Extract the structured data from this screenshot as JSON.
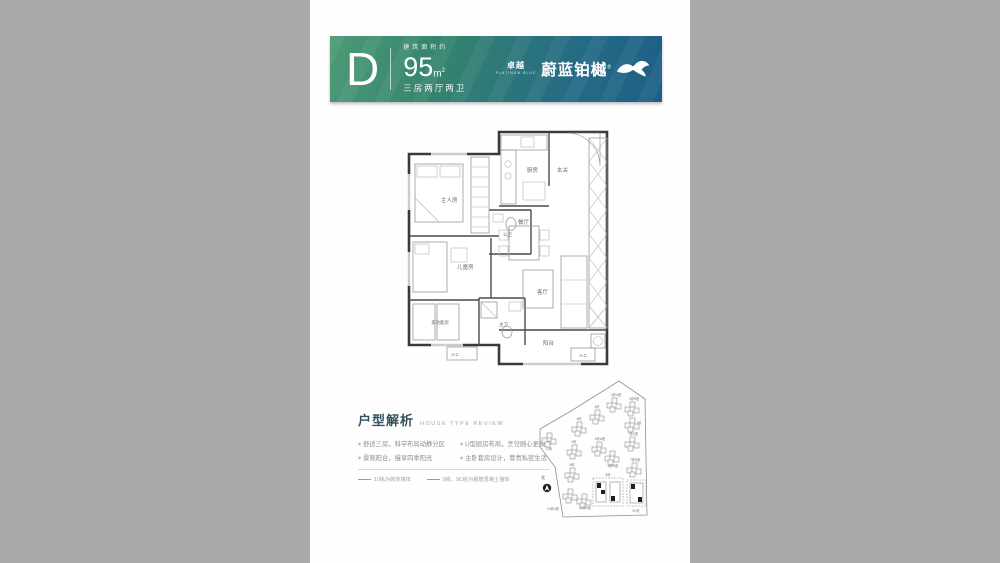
{
  "colors": {
    "side_gray": "#a9a9a9",
    "paper": "#fefefe",
    "banner_green": "#4d9a76",
    "banner_blue": "#1d5f86",
    "title_text": "#33525f"
  },
  "header": {
    "unit_letter": "D",
    "area_prefix": "建筑面积约",
    "area_value": "95",
    "area_unit_m": "m",
    "area_unit_sup": "2",
    "unit_layout": "三房两厅两卫",
    "brand_prefix": "卓越",
    "brand_prefix_en": "PLATINUM BLUE",
    "brand_name": "蔚蓝铂樾",
    "brand_mark": "®"
  },
  "floorplan": {
    "rooms": [
      {
        "label": "主人房"
      },
      {
        "label": "公卫"
      },
      {
        "label": "儿童房"
      },
      {
        "label": "多功能房"
      },
      {
        "label": "主卫"
      },
      {
        "label": "厨房"
      },
      {
        "label": "玄关"
      },
      {
        "label": "餐厅"
      },
      {
        "label": "客厅"
      },
      {
        "label": "阳台"
      }
    ],
    "ac_label_1": "A.C",
    "ac_label_2": "A.C"
  },
  "review": {
    "title": "户型解析",
    "subtitle": "HOUSE TYPE REVIEW",
    "bullets": [
      "舒适三房，科学布局动静分区",
      "U型厨房布局，烹饪随心更顺手",
      "景观阳台，慢享四季阳光",
      "主卧套房设计，尊贵私密生活"
    ],
    "legend": [
      {
        "label": "10栋为砌体墙体"
      },
      {
        "label": "9栋、9C栋为钢筋混凝土墙体"
      }
    ]
  },
  "siteplan": {
    "north_label": "北",
    "buildings": [
      {
        "label": "2栋A座"
      },
      {
        "label": "2栋B座"
      },
      {
        "label": "1栋"
      },
      {
        "label": "3栋"
      },
      {
        "label": "4栋"
      },
      {
        "label": "5栋"
      },
      {
        "label": "6栋A座"
      },
      {
        "label": "6栋B座"
      },
      {
        "label": "7栋A座"
      },
      {
        "label": "7栋B座"
      },
      {
        "label": "8栋"
      },
      {
        "label": "11栋"
      },
      {
        "label": "10栋A座"
      },
      {
        "label": "10栋B座"
      },
      {
        "label": "9栋"
      },
      {
        "label": "9C栋"
      }
    ]
  }
}
